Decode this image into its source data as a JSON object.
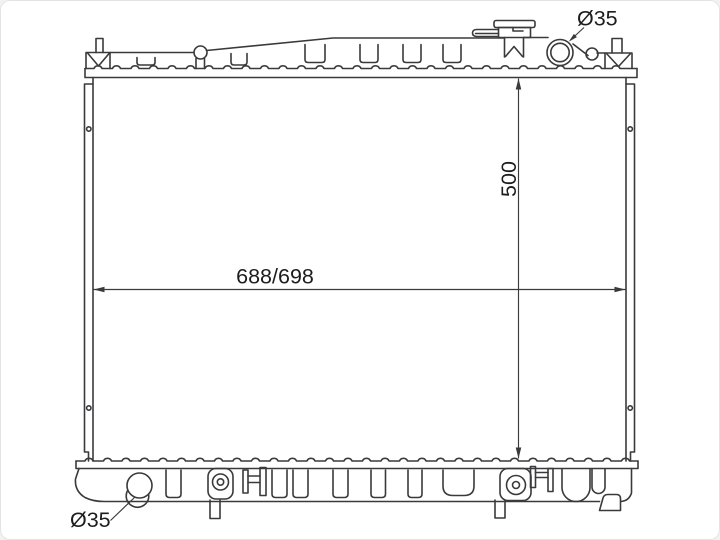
{
  "diagram": {
    "type": "technical-drawing",
    "subject": "automotive-radiator-front-view",
    "labels": {
      "width_dimension": "688/698",
      "height_dimension": "500",
      "top_port_diameter": "Ø35",
      "bottom_port_diameter": "Ø35"
    },
    "colors": {
      "line": "#3a3a3c",
      "text": "#1d1d1f",
      "background": "#ffffff"
    }
  }
}
